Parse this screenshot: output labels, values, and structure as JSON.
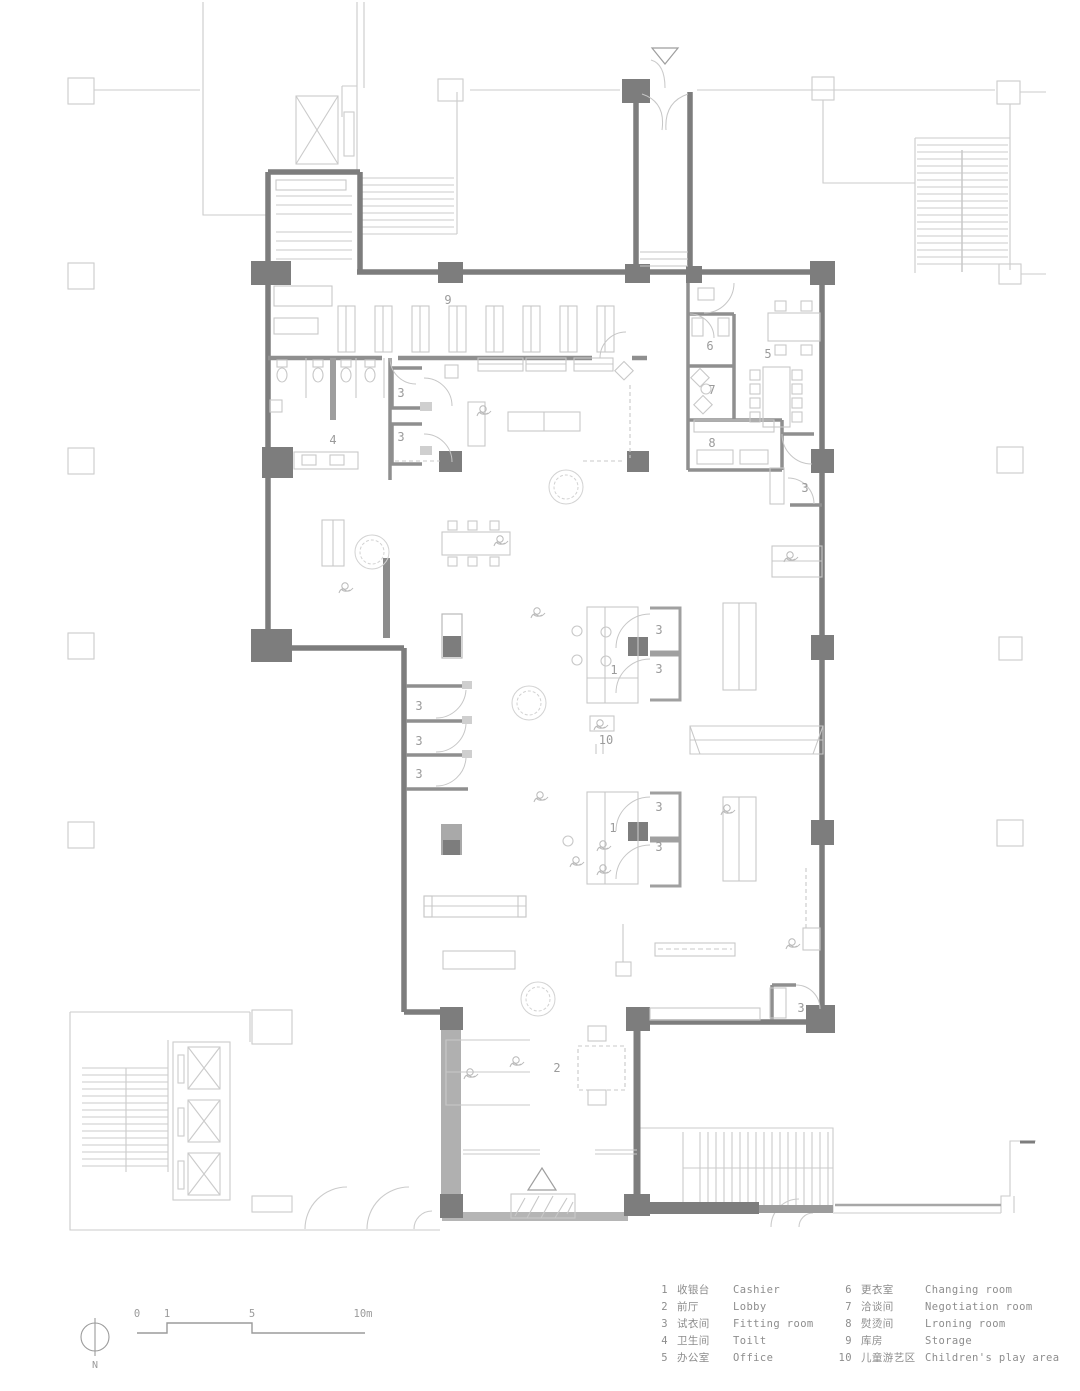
{
  "title": "Retail store floor plan",
  "colors": {
    "wall_dark": "#7d7d7d",
    "wall_medium": "#9e9e9e",
    "line_light": "#cbcbcb",
    "label_text": "#9b9b9b",
    "legend_text": "#8d8d8d",
    "background": "#ffffff"
  },
  "plan": {
    "room_labels": [
      {
        "label": "9",
        "x": 448,
        "y": 304
      },
      {
        "label": "4",
        "x": 333,
        "y": 444
      },
      {
        "label": "6",
        "x": 710,
        "y": 350
      },
      {
        "label": "7",
        "x": 712,
        "y": 394
      },
      {
        "label": "8",
        "x": 712,
        "y": 447
      },
      {
        "label": "5",
        "x": 768,
        "y": 358
      },
      {
        "label": "1",
        "x": 614,
        "y": 674
      },
      {
        "label": "1",
        "x": 613,
        "y": 832
      },
      {
        "label": "10",
        "x": 606,
        "y": 744
      },
      {
        "label": "2",
        "x": 557,
        "y": 1072
      },
      {
        "label": "3",
        "x": 401,
        "y": 397
      },
      {
        "label": "3",
        "x": 401,
        "y": 441
      },
      {
        "label": "3",
        "x": 419,
        "y": 710
      },
      {
        "label": "3",
        "x": 419,
        "y": 745
      },
      {
        "label": "3",
        "x": 419,
        "y": 778
      },
      {
        "label": "3",
        "x": 659,
        "y": 634
      },
      {
        "label": "3",
        "x": 659,
        "y": 673
      },
      {
        "label": "3",
        "x": 659,
        "y": 811
      },
      {
        "label": "3",
        "x": 659,
        "y": 851
      },
      {
        "label": "3",
        "x": 805,
        "y": 492
      },
      {
        "label": "3",
        "x": 801,
        "y": 1012
      }
    ]
  },
  "legend": {
    "columns": [
      {
        "items": [
          {
            "num": "1",
            "zh": "收银台",
            "en": "Cashier"
          },
          {
            "num": "2",
            "zh": "前厅",
            "en": "Lobby"
          },
          {
            "num": "3",
            "zh": "试衣间",
            "en": "Fitting room"
          },
          {
            "num": "4",
            "zh": "卫生间",
            "en": "Toilt"
          },
          {
            "num": "5",
            "zh": "办公室",
            "en": "Office"
          }
        ]
      },
      {
        "items": [
          {
            "num": "6",
            "zh": "更衣室",
            "en": "Changing room"
          },
          {
            "num": "7",
            "zh": "洽谈间",
            "en": "Negotiation room"
          },
          {
            "num": "8",
            "zh": "熨烫间",
            "en": "Lroning room"
          },
          {
            "num": "9",
            "zh": "库房",
            "en": "Storage"
          },
          {
            "num": "10",
            "zh": "儿童游艺区",
            "en": "Children's play area"
          }
        ]
      }
    ]
  },
  "scale_bar": {
    "ticks": [
      "0",
      "1",
      "5",
      "10m"
    ]
  },
  "north_label": "N"
}
